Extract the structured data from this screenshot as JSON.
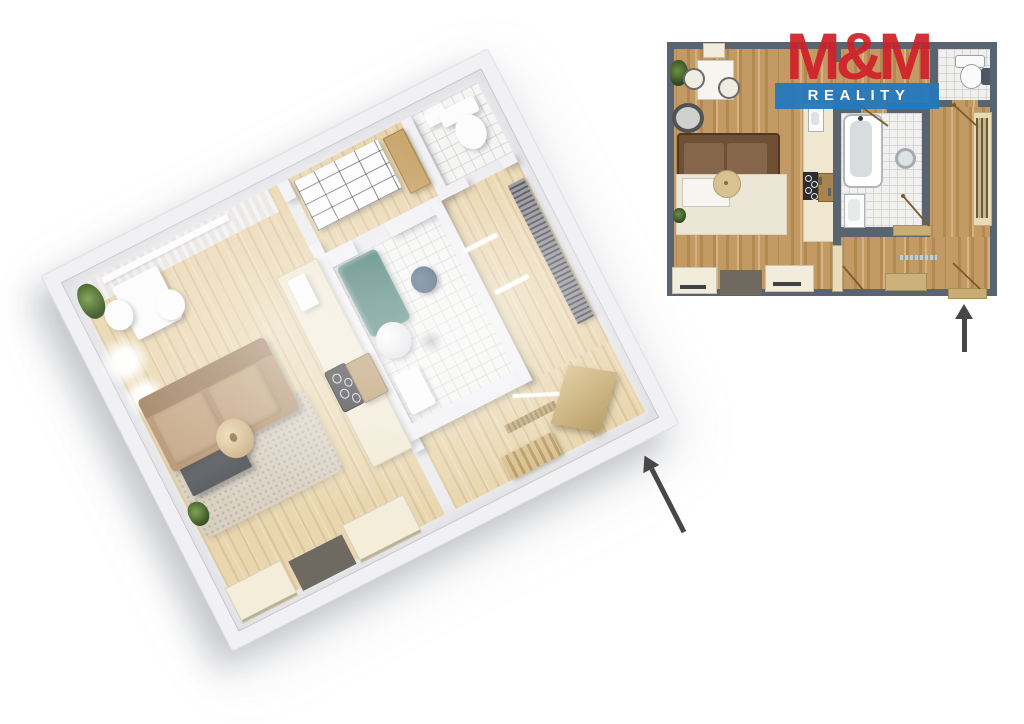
{
  "page": {
    "background": "#ffffff",
    "description": "Apartment floor plan: 3D render at left, 2D plan top right, arrows marking the entrance"
  },
  "logo": {
    "line1": "M&M",
    "line2": "REALITY"
  },
  "icons": {
    "entrance_arrow_3d": "arrow-up-left-icon",
    "entrance_arrow_2d": "arrow-up-icon"
  },
  "colors": {
    "page-bg": "#ffffff",
    "logo-red": "#d02129",
    "logo-blue": "#2379bd",
    "logo-text": "#ffffff",
    "wall-2d": "#5a6370",
    "wood-2d": "#c39a63",
    "tile-2d": "#f0f0ee",
    "rug-2d": "#ece6d7",
    "sofa-2d": "#6f5034",
    "pouf-2d": "#d8c292",
    "door-line": "#7c5a2b",
    "door-tan": "#c9ad74",
    "wall-3d": "#f1f1f4",
    "wood-3d": "#e9d6ae",
    "rug-3d": "#d8cfc0",
    "sofa-3d": "#b3906c",
    "teal-tub": "#2f6b63",
    "navy-stool": "#2b4765",
    "arrow": "#474747"
  }
}
